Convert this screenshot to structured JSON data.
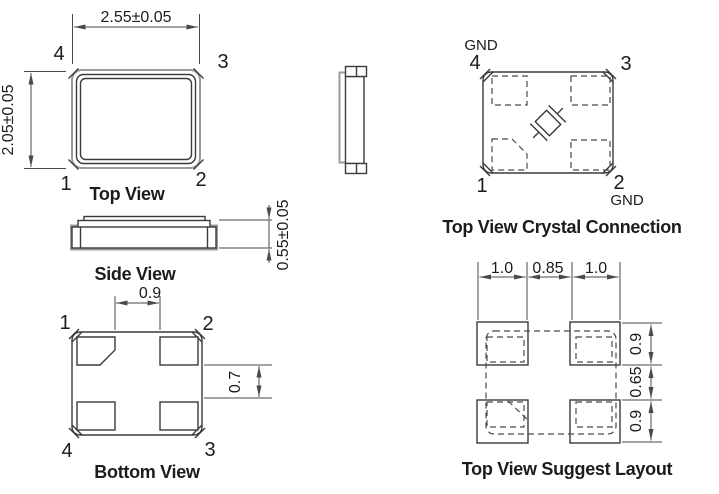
{
  "colors": {
    "line": "#3a3a3a",
    "dim_line": "#4a4a4a",
    "gray_line": "#9b9b9b",
    "text": "#1c1c1c",
    "background": "#ffffff"
  },
  "top_view": {
    "caption": "Top View",
    "width_dim": "2.55±0.05",
    "height_dim": "2.05±0.05",
    "pin_top_left": "4",
    "pin_top_right": "3",
    "pin_bottom_left": "1",
    "pin_bottom_right": "2"
  },
  "side_view": {
    "caption": "Side View",
    "thickness_dim": "0.55±0.05"
  },
  "bottom_view": {
    "caption": "Bottom View",
    "pad_gap_dim": "0.9",
    "pad_side_gap_dim": "0.7",
    "pin_top_left": "1",
    "pin_top_right": "2",
    "pin_bottom_left": "4",
    "pin_bottom_right": "3"
  },
  "crystal_connection": {
    "caption": "Top View Crystal Connection",
    "gnd_top": "GND",
    "gnd_bottom": "GND",
    "pin_top_left": "4",
    "pin_top_right": "3",
    "pin_bottom_left": "1",
    "pin_bottom_right": "2"
  },
  "suggest_layout": {
    "caption": "Top View Suggest Layout",
    "pad_width_left": "1.0",
    "pad_gap": "0.85",
    "pad_width_right": "1.0",
    "pad_height_top": "0.9",
    "pad_vgap": "0.65",
    "pad_height_bottom": "0.9"
  }
}
